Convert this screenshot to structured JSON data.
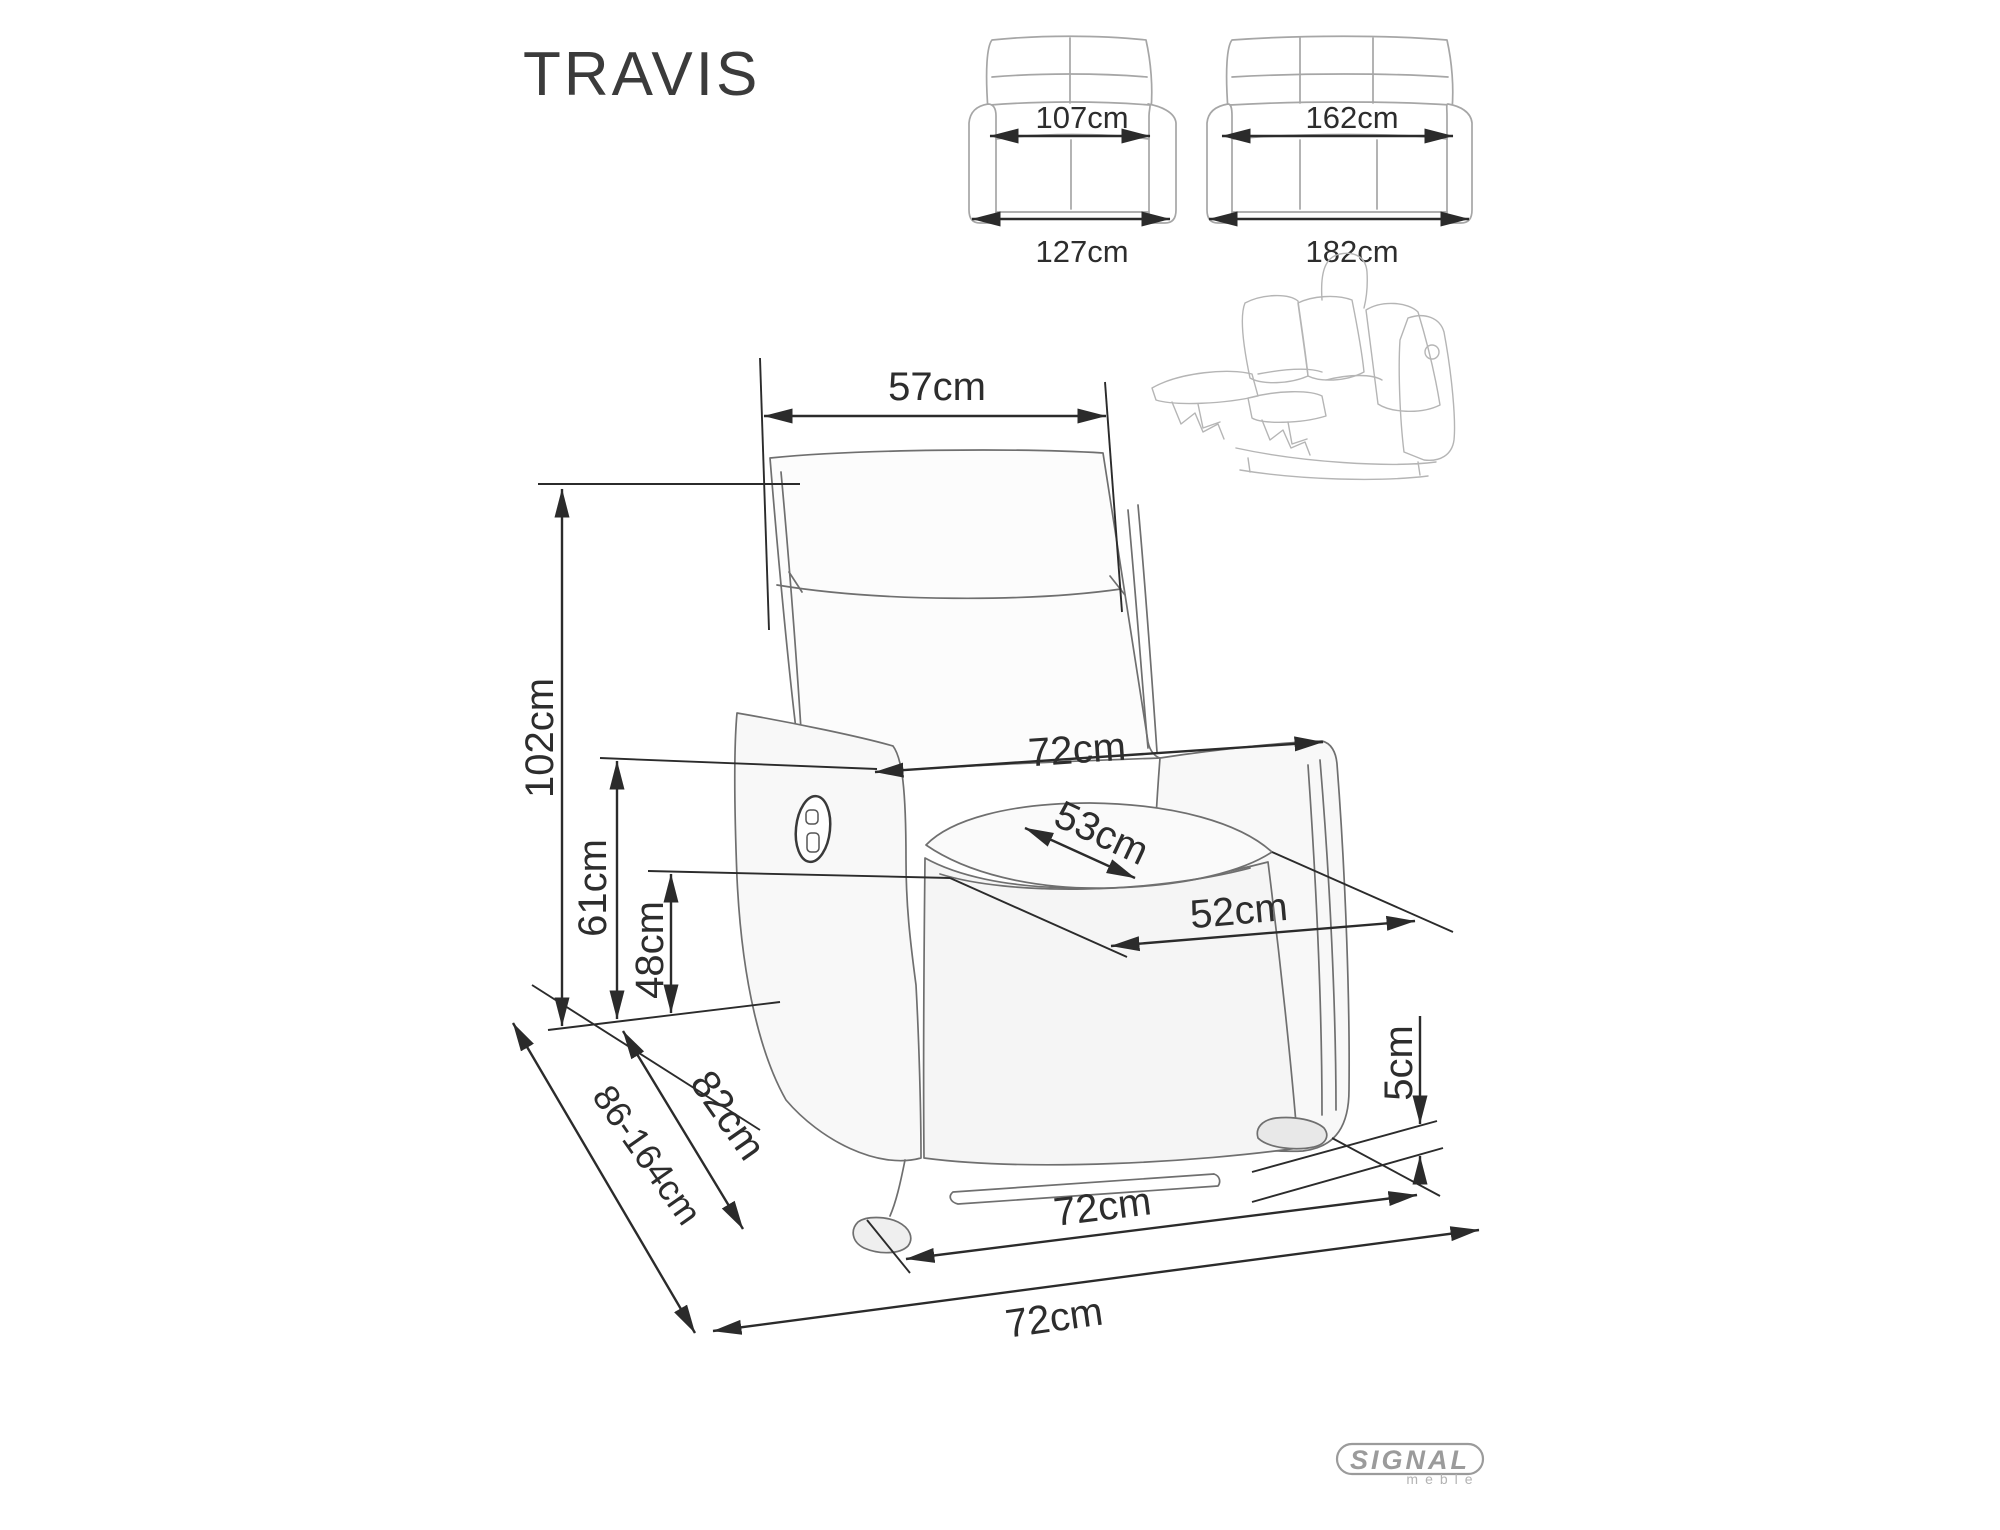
{
  "title": "TRAVIS",
  "logo": {
    "brand": "SIGNAL",
    "sub": "meble"
  },
  "sofa_two_seat": {
    "inner_width": "107cm",
    "outer_width": "127cm"
  },
  "sofa_three_seat": {
    "inner_width": "162cm",
    "outer_width": "182cm"
  },
  "armchair": {
    "backrest_width": "57cm",
    "height": "102cm",
    "armrest_height": "61cm",
    "seat_height": "48cm",
    "width_overall": "72cm",
    "seat_width": "53cm",
    "seat_depth": "52cm",
    "ground_clearance": "5cm",
    "depth": "82cm",
    "depth_reclined": "86-164cm",
    "base_depth": "72cm",
    "footprint_width": "72cm"
  },
  "colors": {
    "dimension_line": "#2b2b2b",
    "dimension_text": "#2d2d2d",
    "chair_sketch": "#6f6f6f",
    "thumbnail_sketch": "#a6a6a6",
    "logo_gray": "#9b9b9b",
    "background": "#ffffff"
  }
}
